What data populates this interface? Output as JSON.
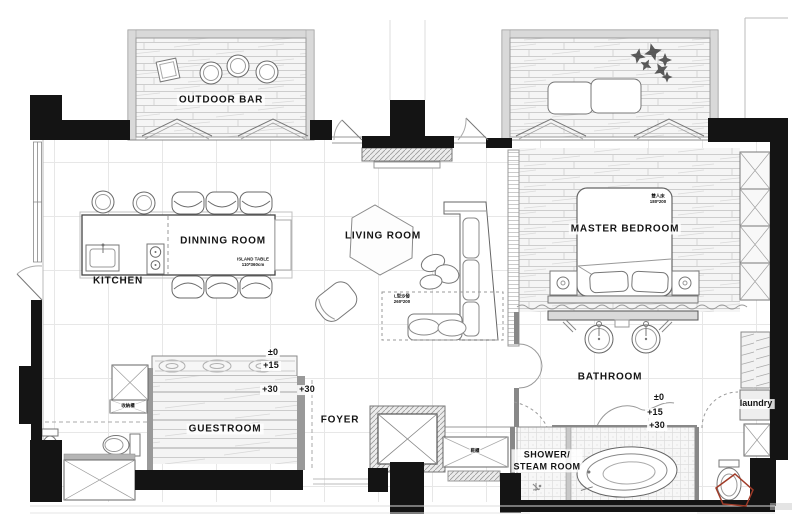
{
  "rooms": {
    "outdoor_bar": "OUTDOOR BAR",
    "dinning_room": "DINNING ROOM",
    "kitchen": "KITCHEN",
    "living_room": "LIVING ROOM",
    "master_bedroom": "MASTER BEDROOM",
    "bathroom": "BATHROOM",
    "guestroom": "GUESTROOM",
    "foyer": "FOYER",
    "shower_steam_line1": "SHOWER/",
    "shower_steam_line2": "STEAM ROOM",
    "laundry": "laundry"
  },
  "annotations": {
    "island_table_name": "ISLAND TABLE",
    "island_table_size": "110*360cm",
    "sofa_name": "L型沙發",
    "sofa_size": "260*200",
    "bed_name": "雙人床",
    "bed_size": "180*200",
    "cabinet_label": "收納櫃",
    "shoe_cabinet_label": "鞋櫃"
  },
  "levels": {
    "zero": "±0",
    "plus15": "+15",
    "plus30": "+30"
  },
  "colors": {
    "wall": "#141414",
    "furniture_line": "#6a6a6a",
    "grid_line": "#e7e7e7",
    "watermark_red": "#a03b28"
  }
}
